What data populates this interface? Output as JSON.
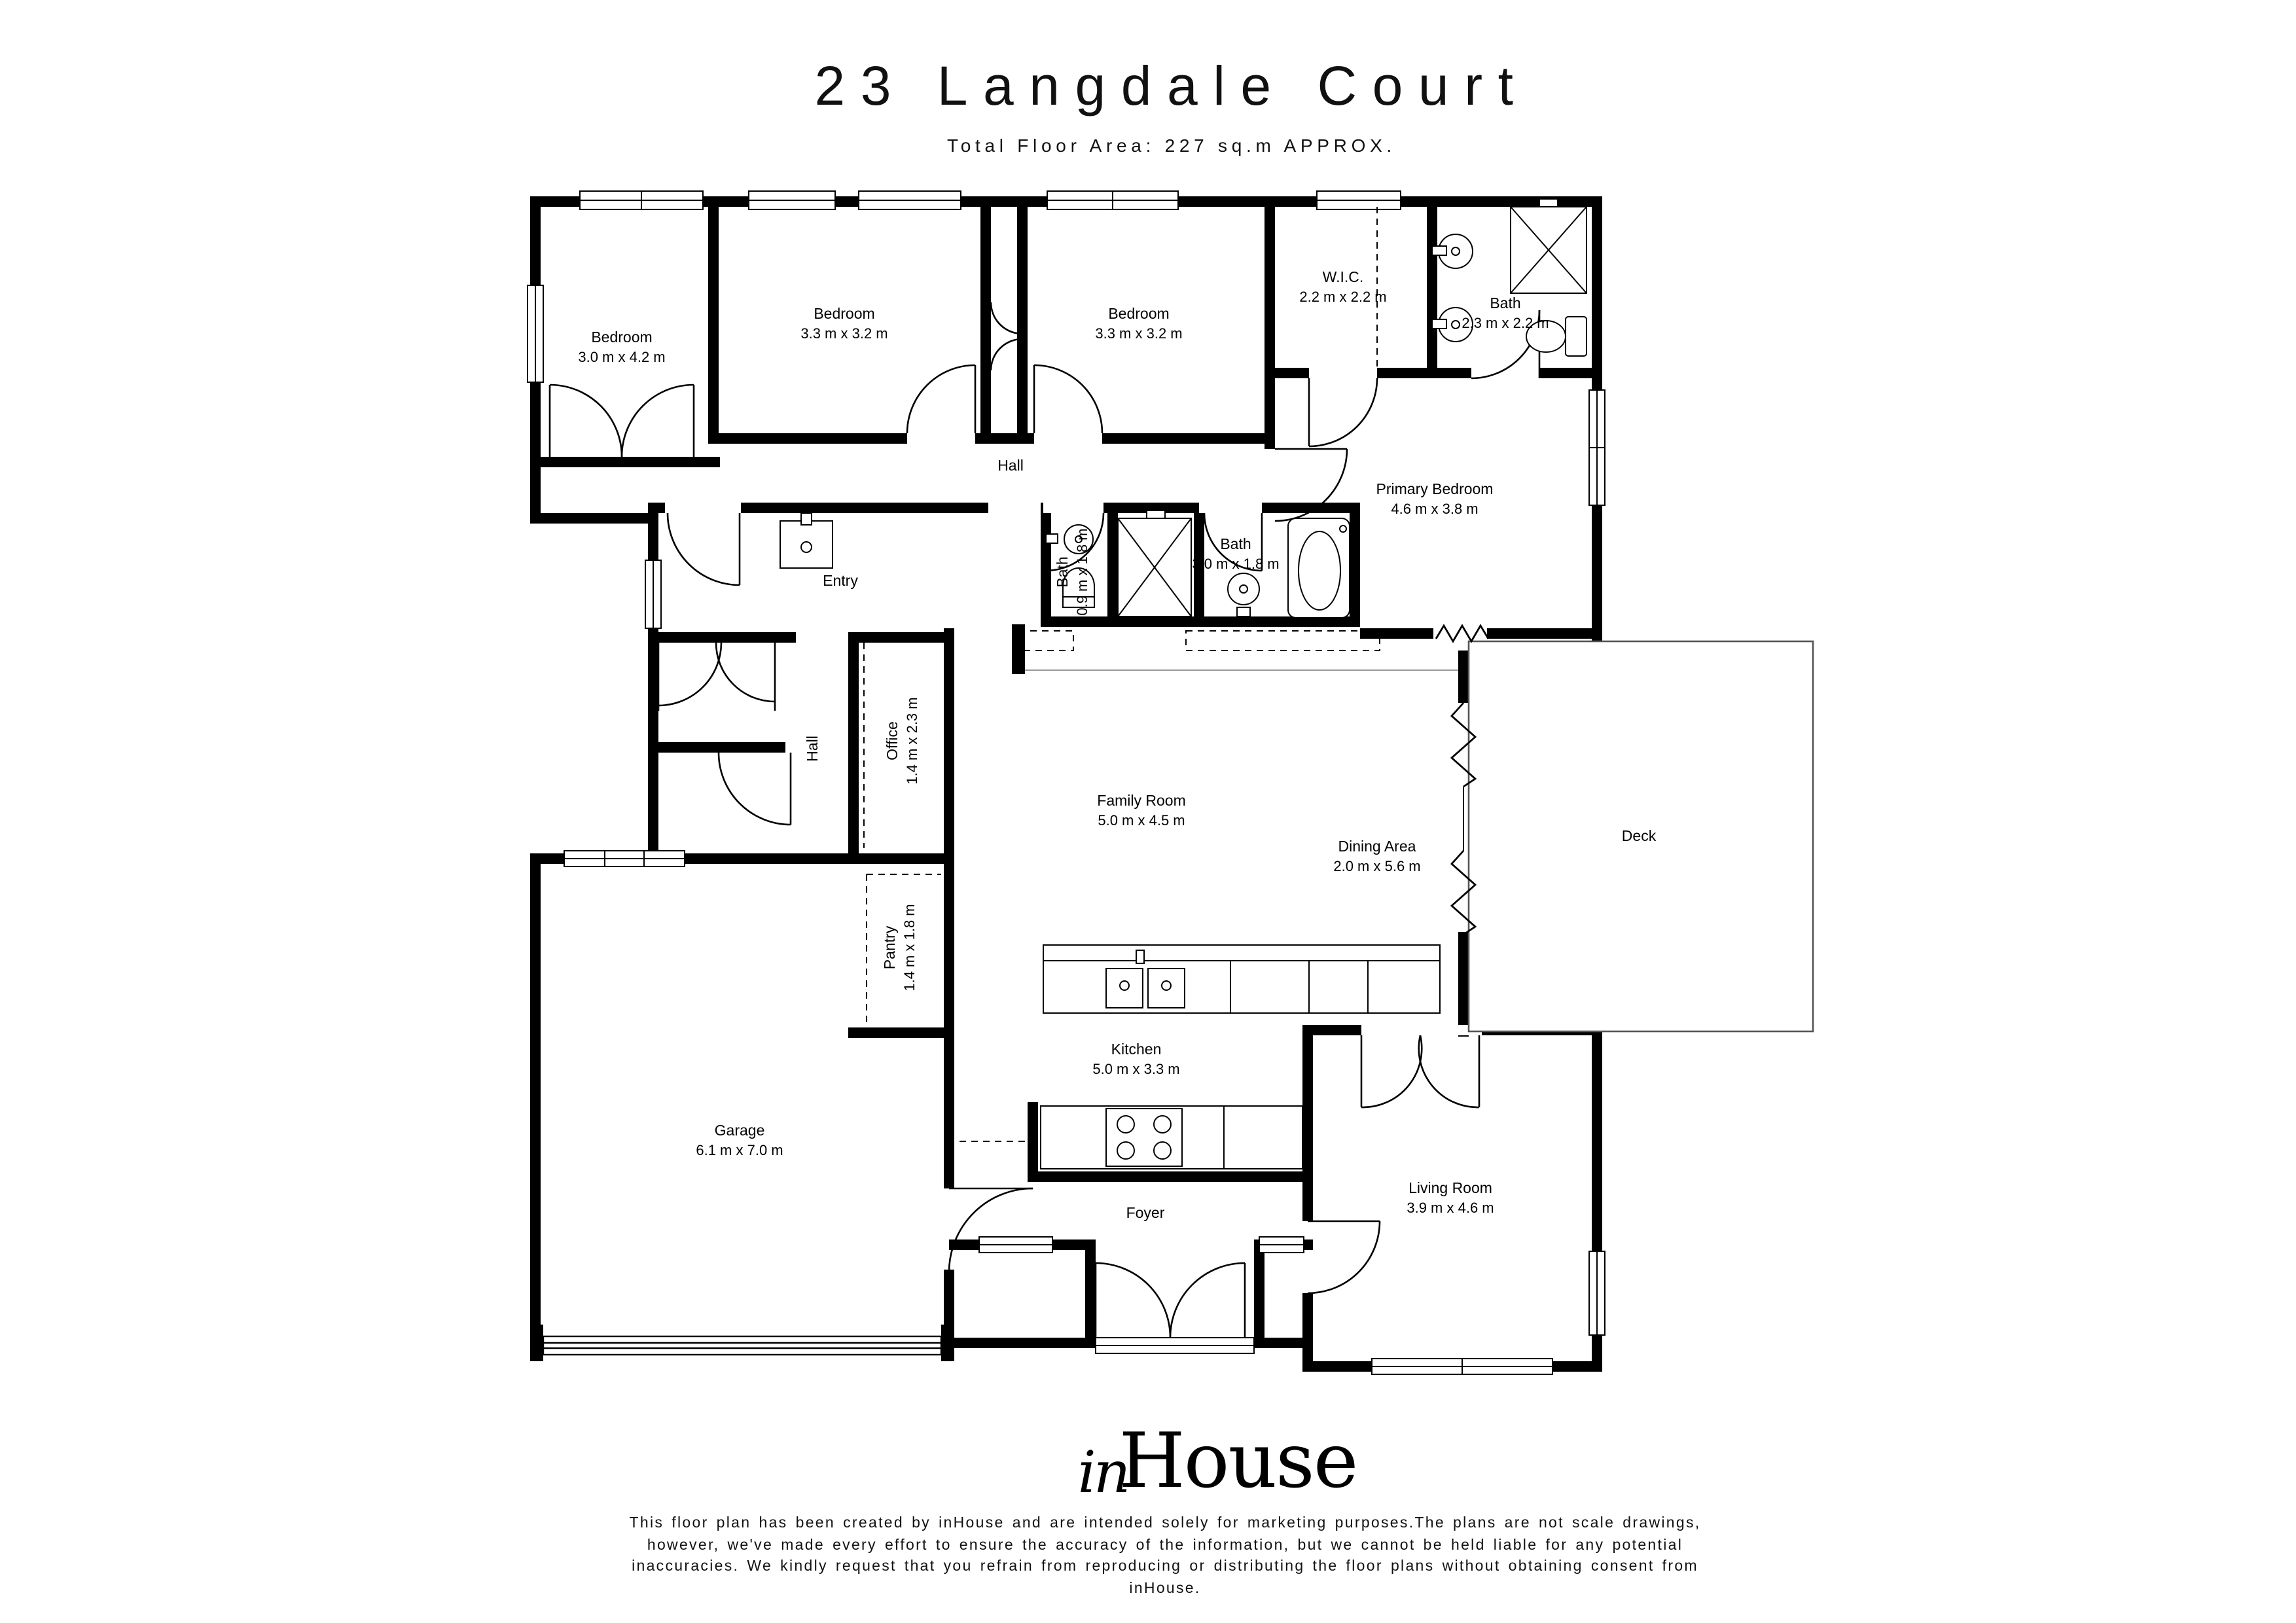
{
  "header": {
    "title": "23 Langdale Court",
    "subtitle": "Total Floor Area: 227 sq.m APPROX."
  },
  "rooms": {
    "bedroom1": {
      "name": "Bedroom",
      "dims": "3.0 m x 4.2 m"
    },
    "bedroom2": {
      "name": "Bedroom",
      "dims": "3.3 m x 3.2 m"
    },
    "bedroom3": {
      "name": "Bedroom",
      "dims": "3.3 m x 3.2 m"
    },
    "wic": {
      "name": "W.I.C.",
      "dims": "2.2 m x 2.2 m"
    },
    "bath_top": {
      "name": "Bath",
      "dims": "2.3 m x 2.2 m"
    },
    "primary_bedroom": {
      "name": "Primary Bedroom",
      "dims": "4.6 m x 3.8 m"
    },
    "hall_top": {
      "name": "Hall"
    },
    "entry": {
      "name": "Entry"
    },
    "bath_small": {
      "name": "Bath",
      "dims": "0.9 m x 1.8 m"
    },
    "bath_main": {
      "name": "Bath",
      "dims": "3.0 m x 1.8 m"
    },
    "family_room": {
      "name": "Family Room",
      "dims": "5.0 m x 4.5 m"
    },
    "dining_area": {
      "name": "Dining Area",
      "dims": "2.0 m x 5.6 m"
    },
    "deck": {
      "name": "Deck"
    },
    "hall_mid": {
      "name": "Hall"
    },
    "office": {
      "name": "Office",
      "dims": "1.4 m x 2.3 m"
    },
    "pantry": {
      "name": "Pantry",
      "dims": "1.4 m x 1.8 m"
    },
    "garage": {
      "name": "Garage",
      "dims": "6.1 m x 7.0 m"
    },
    "kitchen": {
      "name": "Kitchen",
      "dims": "5.0 m x 3.3 m"
    },
    "living_room": {
      "name": "Living Room",
      "dims": "3.9 m x 4.6 m"
    },
    "foyer": {
      "name": "Foyer"
    }
  },
  "footer": {
    "logo_script": "in",
    "logo_serif": "House",
    "disclaimer": "This floor plan has been created by inHouse and are intended solely for marketing purposes.The plans are not scale drawings, however, we've made every effort to ensure the accuracy of the information, but we cannot be held liable for any potential inaccuracies. We kindly request that you refrain from reproducing or distributing the floor plans without obtaining consent from inHouse."
  }
}
